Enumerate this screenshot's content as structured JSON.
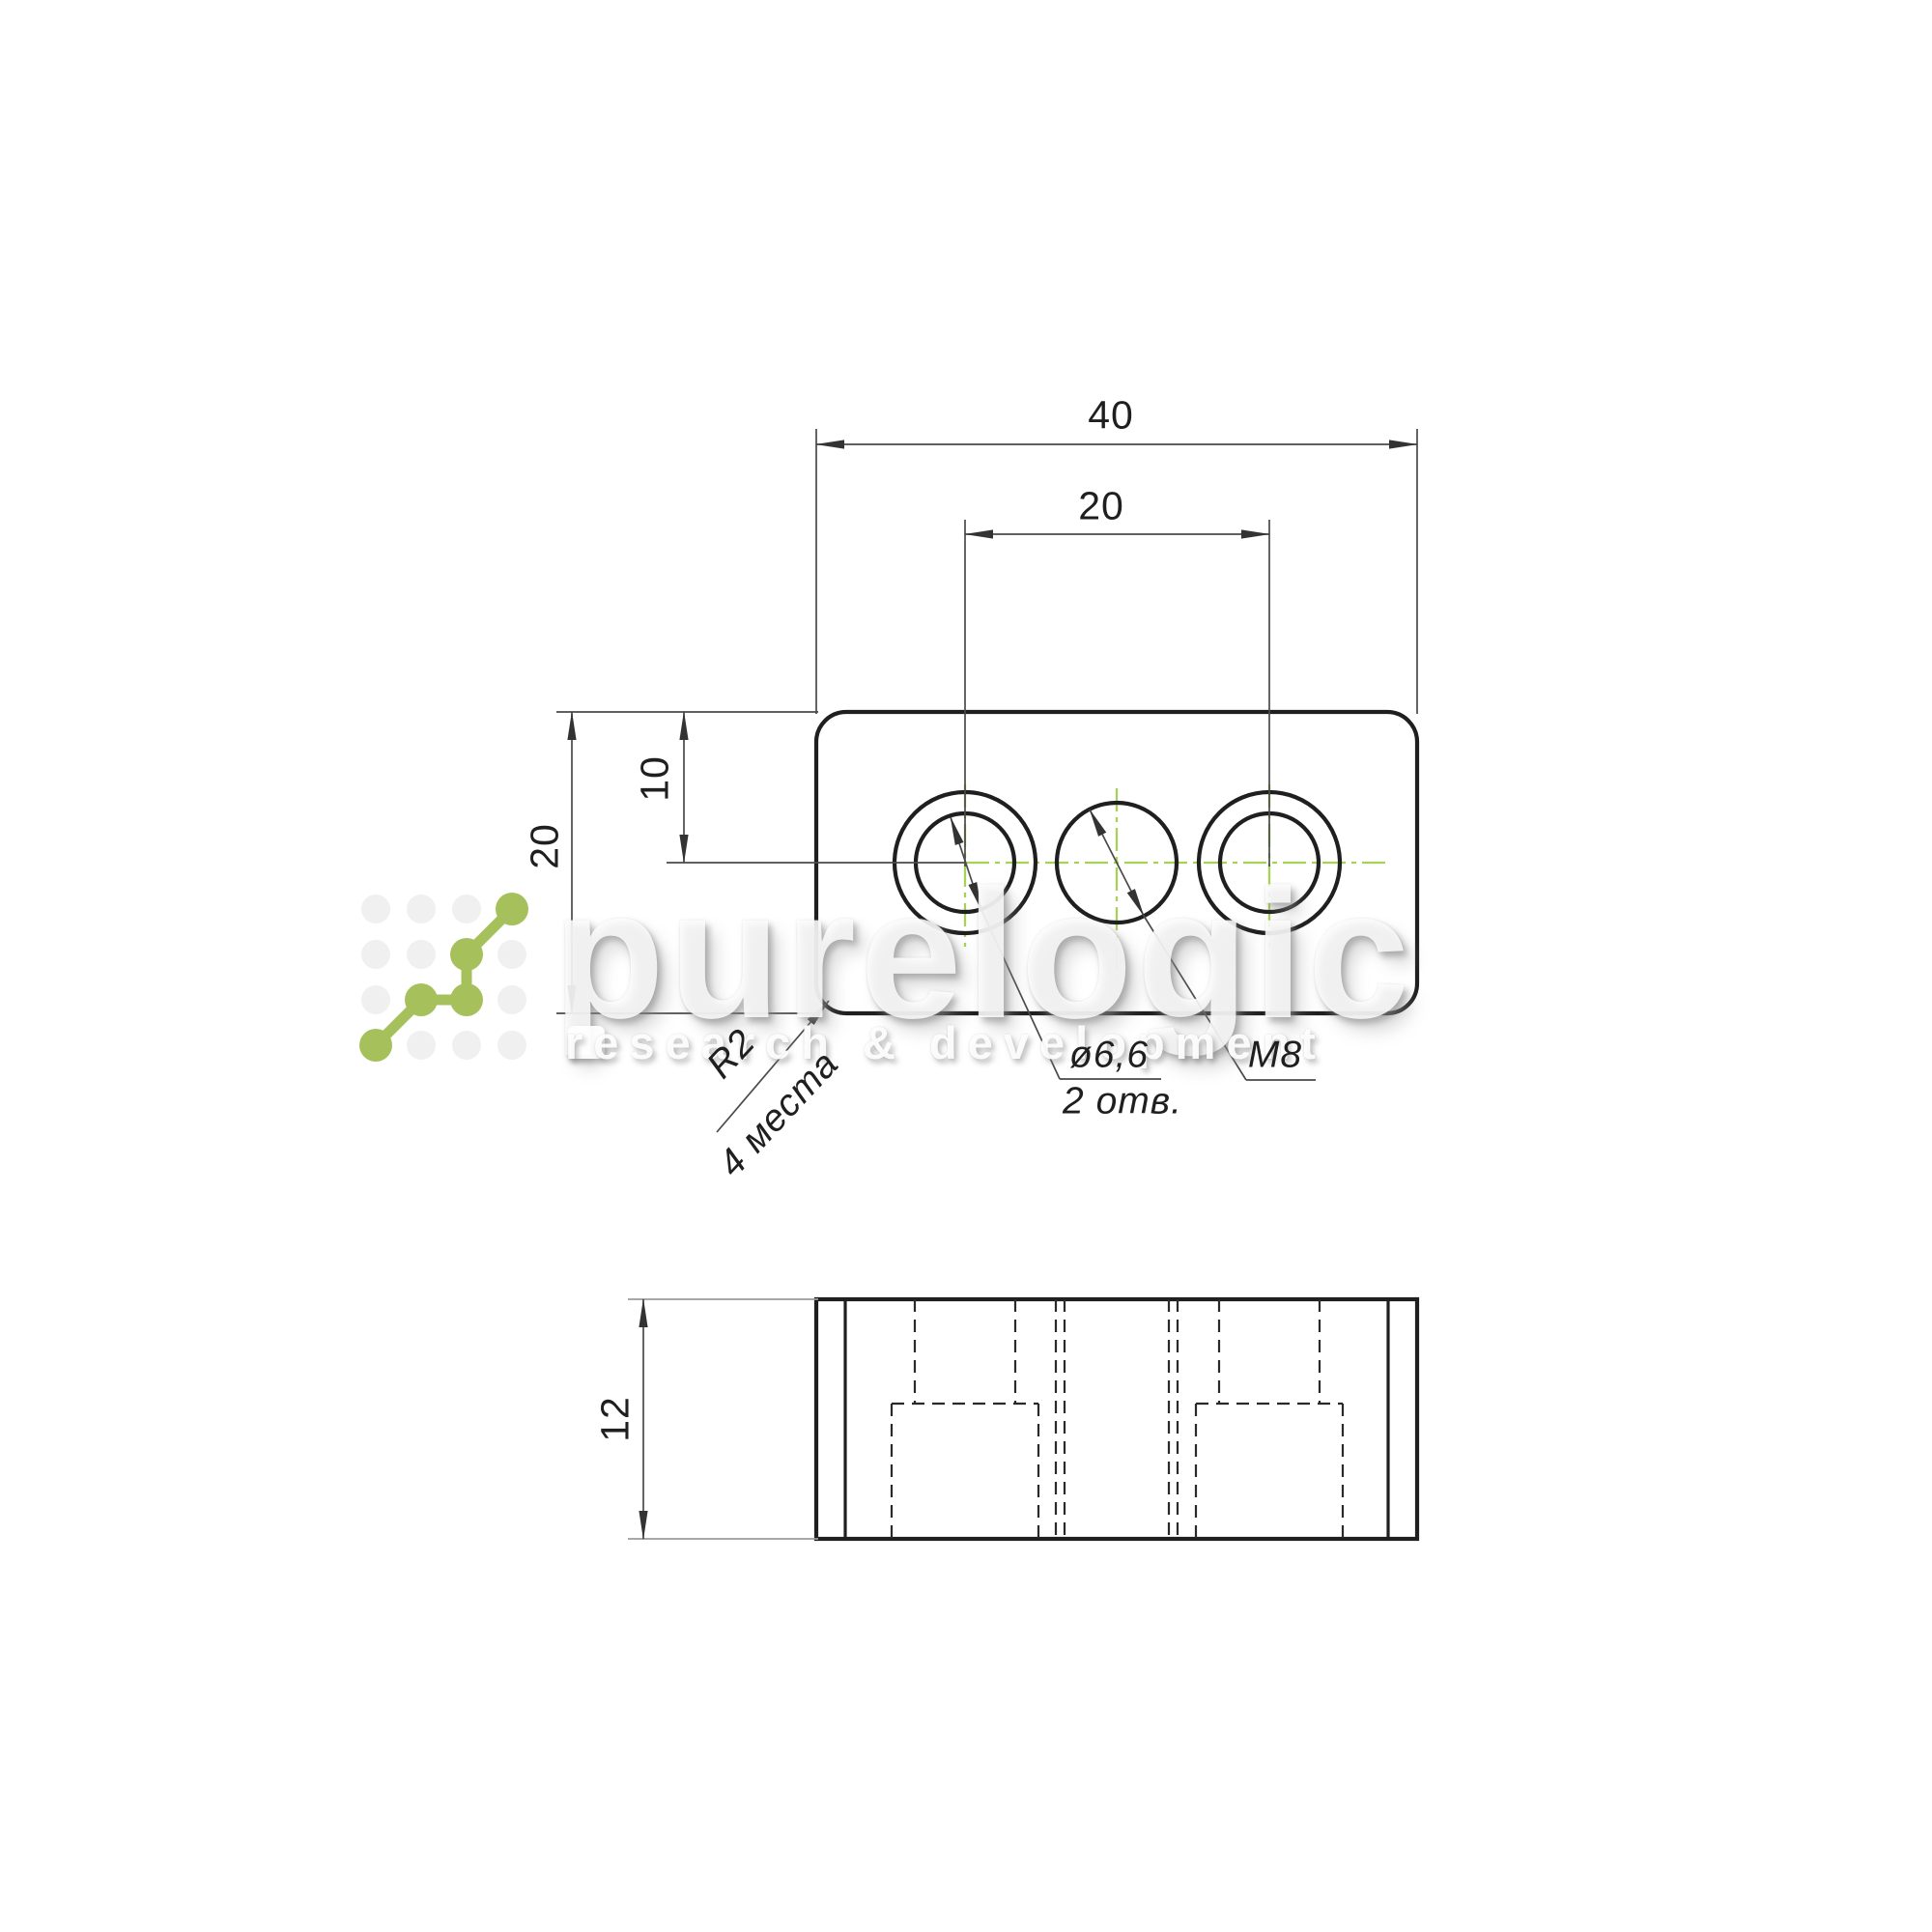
{
  "drawing": {
    "top_view": {
      "width_dim": "40",
      "hole_spacing_dim": "20",
      "height_dim": "20",
      "centerline_offset_dim": "10",
      "callouts": {
        "hole_diameter": "ø6,6",
        "hole_count": "2 отв.",
        "thread": "M8",
        "corner_radius": "R2",
        "radius_places": "4 места"
      }
    },
    "side_view": {
      "thickness_dim": "12"
    },
    "colors": {
      "outline": "#1f1f1f",
      "thin_line": "#4a4a4a",
      "centerline_green": "#a8d257",
      "logo_green": "#a6c15b"
    }
  },
  "watermark": {
    "brand": "purelogic",
    "tagline": "research & development"
  }
}
